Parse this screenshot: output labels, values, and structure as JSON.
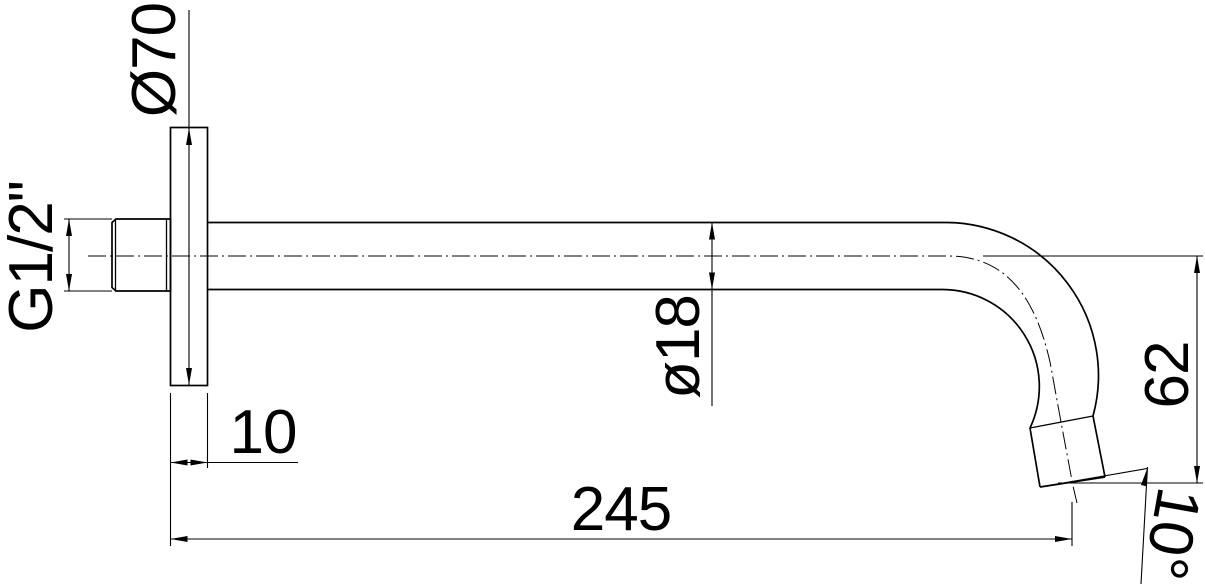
{
  "drawing": {
    "labels": {
      "flange_diameter": "Ø70",
      "thread": "G1/2\"",
      "pipe_diameter": "ø18",
      "flange_thickness": "10",
      "projection_length": "245",
      "drop_height": "62",
      "tip_angle": "10°"
    }
  }
}
